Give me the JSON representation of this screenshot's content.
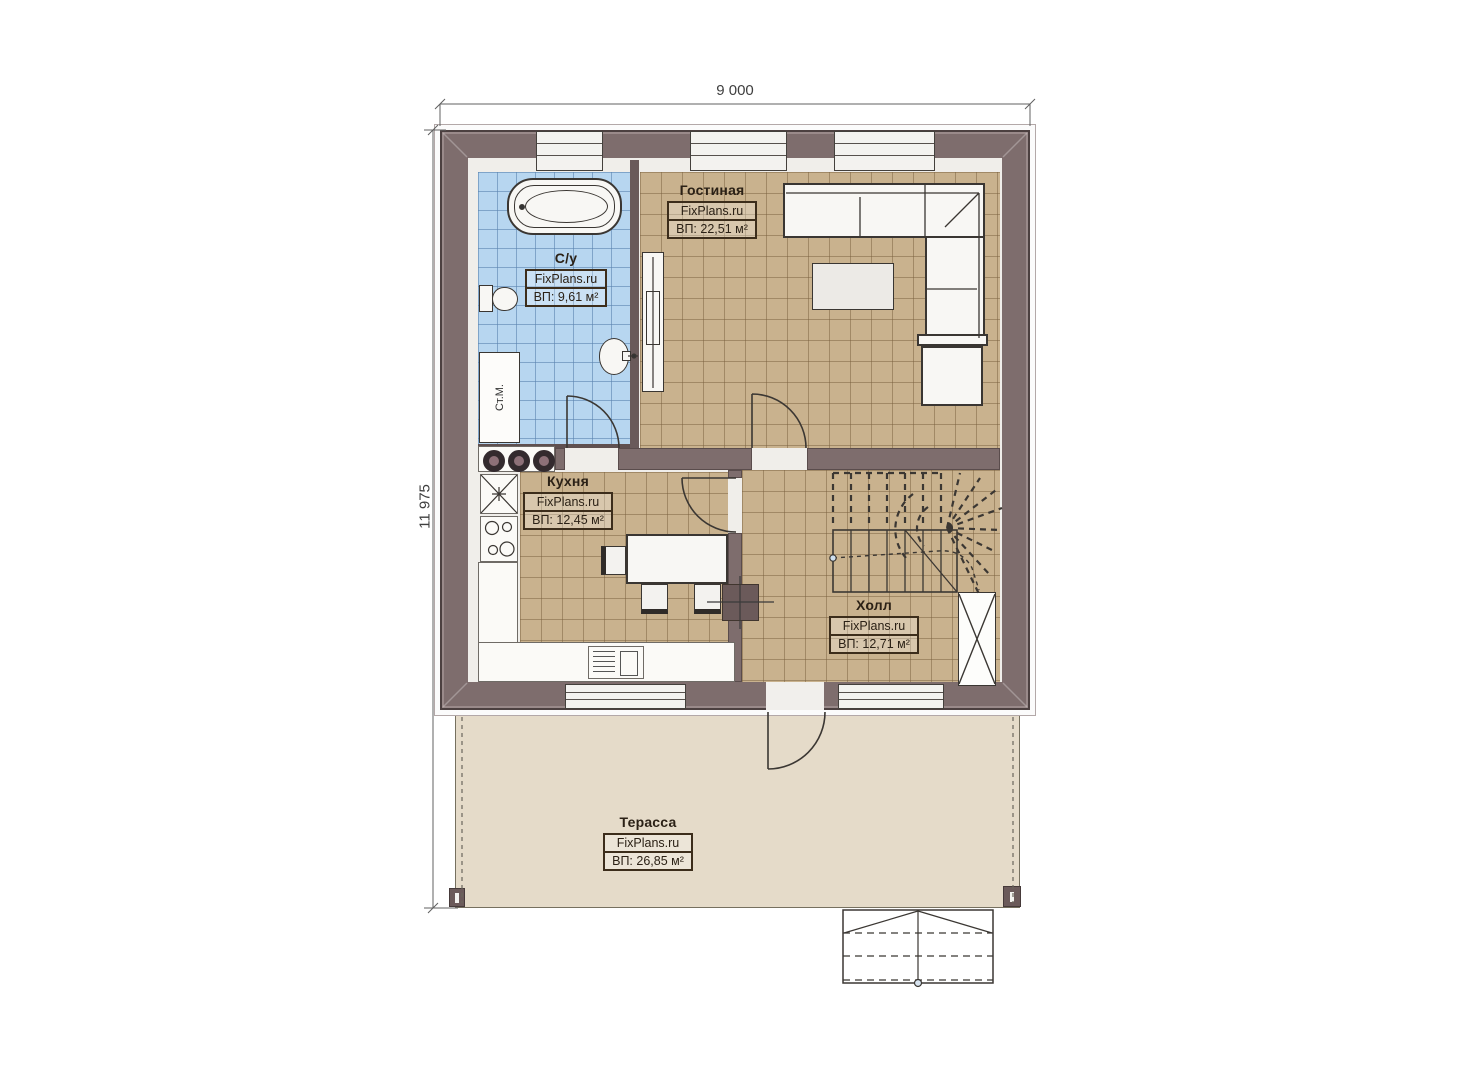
{
  "dimensions": {
    "top": "9 000",
    "left": "11 975"
  },
  "watermark": "FixPlans.ru",
  "rooms": {
    "bathroom": {
      "name": "С/у",
      "watermark": "FixPlans.ru",
      "area": "ВП: 9,61 м²"
    },
    "living": {
      "name": "Гостиная",
      "watermark": "FixPlans.ru",
      "area": "ВП: 22,51 м²"
    },
    "kitchen": {
      "name": "Кухня",
      "watermark": "FixPlans.ru",
      "area": "ВП: 12,45 м²"
    },
    "hall": {
      "name": "Холл",
      "watermark": "FixPlans.ru",
      "area": "ВП: 12,71 м²"
    },
    "terrace": {
      "name": "Терасса",
      "watermark": "FixPlans.ru",
      "area": "ВП: 26,85 м²"
    }
  },
  "appliances": {
    "washing_machine": "Ст.М."
  },
  "colors": {
    "wall": "#7e6d6d",
    "floor_tile": "#c9b28e",
    "bathroom_tile": "#b7d6f0",
    "terrace": "#e5dbc9"
  }
}
